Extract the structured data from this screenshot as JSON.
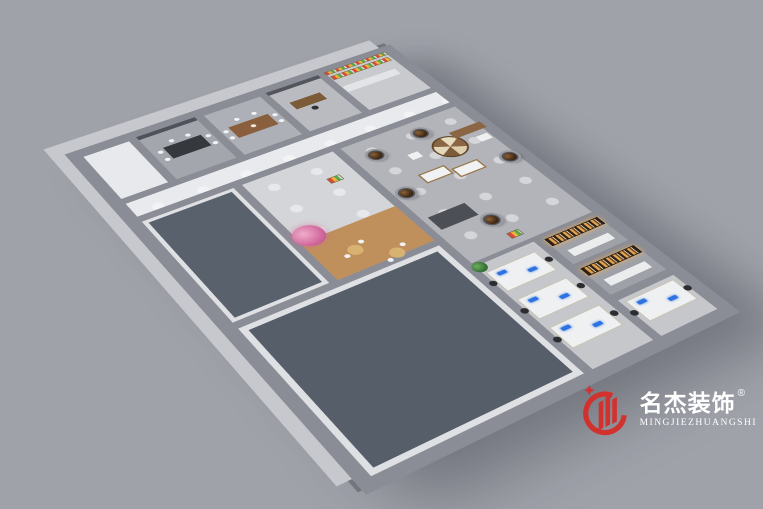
{
  "colors": {
    "background": "#a0a2aa",
    "wall": "#8b8d96",
    "wall_outer_light": "#c7c8ce",
    "accent_red": "#d2322e",
    "logo_text": "#ffffff"
  },
  "logo": {
    "name_cn": "名杰装饰",
    "registered_mark": "®",
    "name_en": "MINGJIEZHUANGSHI"
  },
  "floorplan": {
    "rooms": [
      {
        "name": "lobby-corner",
        "rect": [
          0,
          0,
          64,
          100
        ],
        "floor": "#e8e9ec"
      },
      {
        "name": "meeting-room-1",
        "rect": [
          64,
          0,
          82,
          100
        ],
        "floor": "#a3a6ad"
      },
      {
        "name": "meeting-room-2-tea",
        "rect": [
          146,
          0,
          82,
          100
        ],
        "floor": "#adb0b6"
      },
      {
        "name": "manager-office",
        "rect": [
          228,
          0,
          78,
          100
        ],
        "floor": "#babbc0"
      },
      {
        "name": "pantry-bar",
        "rect": [
          306,
          0,
          94,
          100
        ],
        "floor": "#c9cacd"
      },
      {
        "name": "corridor",
        "rect": [
          0,
          100,
          400,
          36
        ],
        "floor": "#e9eaed",
        "cls": "pools"
      },
      {
        "name": "training-room-west",
        "rect": [
          0,
          136,
          116,
          194
        ],
        "floor": "#dfe0e3"
      },
      {
        "name": "break-room",
        "rect": [
          116,
          136,
          122,
          194
        ],
        "floor": "#d4d5d8",
        "cls": "pools"
      },
      {
        "name": "showroom",
        "rect": [
          238,
          136,
          162,
          244
        ],
        "floor": "#b3b4b9",
        "cls": "pools"
      },
      {
        "name": "training-room-south",
        "rect": [
          0,
          330,
          238,
          230
        ],
        "floor": "#dfe0e3"
      },
      {
        "name": "open-office",
        "rect": [
          238,
          376,
          82,
          184
        ],
        "floor": "#c6c7cb"
      },
      {
        "name": "open-office-ext",
        "rect": [
          320,
          490,
          80,
          70
        ],
        "floor": "#c6c7cb"
      },
      {
        "name": "material-room-1",
        "rect": [
          320,
          380,
          80,
          55
        ],
        "floor": "#9fa1a8"
      },
      {
        "name": "material-room-2",
        "rect": [
          320,
          435,
          80,
          55
        ],
        "floor": "#9fa1a8"
      }
    ],
    "items": [
      {
        "name": "carpet-west",
        "rect": [
          10,
          146,
          96,
          174
        ],
        "color": "#59616d"
      },
      {
        "name": "carpet-south",
        "rect": [
          12,
          342,
          214,
          206
        ],
        "color": "#565e6a"
      },
      {
        "name": "accent-wall",
        "rect": [
          69,
          2,
          72,
          7
        ],
        "color": "#4f525a"
      },
      {
        "name": "conference-table",
        "rect": [
          84,
          36,
          46,
          24
        ],
        "color": "#35383d"
      },
      {
        "name": "chair",
        "shape": "circle",
        "c": [
          78,
          42
        ],
        "r": 3,
        "color": "#f2f3f5"
      },
      {
        "name": "chair",
        "shape": "circle",
        "c": [
          78,
          58
        ],
        "r": 3,
        "color": "#f2f3f5"
      },
      {
        "name": "chair",
        "shape": "circle",
        "c": [
          136,
          42
        ],
        "r": 3,
        "color": "#f2f3f5"
      },
      {
        "name": "chair",
        "shape": "circle",
        "c": [
          136,
          58
        ],
        "r": 3,
        "color": "#f2f3f5"
      },
      {
        "name": "chair",
        "shape": "circle",
        "c": [
          98,
          29
        ],
        "r": 3,
        "color": "#f2f3f5"
      },
      {
        "name": "chair",
        "shape": "circle",
        "c": [
          118,
          29
        ],
        "r": 3,
        "color": "#f2f3f5"
      },
      {
        "name": "tea-table",
        "rect": [
          162,
          40,
          50,
          24
        ],
        "color": "#8a5f3d"
      },
      {
        "name": "tea-set",
        "shape": "circle",
        "c": [
          187,
          52
        ],
        "r": 3,
        "color": "#f4e9d8"
      },
      {
        "name": "chair",
        "shape": "circle",
        "c": [
          156,
          46
        ],
        "r": 3,
        "color": "#f2f3f5"
      },
      {
        "name": "chair",
        "shape": "circle",
        "c": [
          156,
          60
        ],
        "r": 3,
        "color": "#f2f3f5"
      },
      {
        "name": "chair",
        "shape": "circle",
        "c": [
          218,
          46
        ],
        "r": 3,
        "color": "#f2f3f5"
      },
      {
        "name": "chair",
        "shape": "circle",
        "c": [
          218,
          60
        ],
        "r": 3,
        "color": "#f2f3f5"
      },
      {
        "name": "chair",
        "shape": "circle",
        "c": [
          178,
          31
        ],
        "r": 3,
        "color": "#f2f3f5"
      },
      {
        "name": "chair",
        "shape": "circle",
        "c": [
          200,
          31
        ],
        "r": 3,
        "color": "#f2f3f5"
      },
      {
        "name": "cabinet",
        "rect": [
          232,
          2,
          70,
          7
        ],
        "color": "#53565c"
      },
      {
        "name": "office-desk",
        "rect": [
          244,
          34,
          40,
          16
        ],
        "color": "#7c5b39"
      },
      {
        "name": "office-chair",
        "shape": "circle",
        "c": [
          263,
          58
        ],
        "r": 4,
        "color": "#2e3033"
      },
      {
        "name": "bar-counter",
        "rect": [
          312,
          38,
          72,
          13
        ],
        "color": "#e3e4e7"
      },
      {
        "name": "product-shelf",
        "rect": [
          312,
          12,
          80,
          9
        ],
        "cls": "produce"
      },
      {
        "name": "product-wall",
        "rect": [
          310,
          1,
          86,
          7
        ],
        "cls": "produce"
      },
      {
        "name": "wood-deck",
        "rect": [
          120,
          258,
          114,
          68
        ],
        "color": "#c0905c"
      },
      {
        "name": "blossom-tree",
        "shape": "circle",
        "c": [
          134,
          252
        ],
        "r": 17,
        "cls": "blossom"
      },
      {
        "name": "cafe-table",
        "shape": "circle",
        "c": [
          160,
          296
        ],
        "r": 8,
        "color": "#d8b271"
      },
      {
        "name": "cafe-table",
        "shape": "circle",
        "c": [
          192,
          322
        ],
        "r": 8,
        "color": "#d8b271"
      },
      {
        "name": "chair",
        "shape": "circle",
        "c": [
          148,
          300
        ],
        "r": 3,
        "color": "#f2f3f5"
      },
      {
        "name": "chair",
        "shape": "circle",
        "c": [
          172,
          288
        ],
        "r": 3,
        "color": "#f2f3f5"
      },
      {
        "name": "chair",
        "shape": "circle",
        "c": [
          180,
          328
        ],
        "r": 3,
        "color": "#f2f3f5"
      },
      {
        "name": "chair",
        "shape": "circle",
        "c": [
          204,
          314
        ],
        "r": 3,
        "color": "#f2f3f5"
      },
      {
        "name": "fruit-cart",
        "rect": [
          200,
          180,
          16,
          10
        ],
        "cls": "produce"
      },
      {
        "name": "vase-column",
        "shape": "circle",
        "c": [
          268,
          172
        ],
        "r": 9,
        "cls": "column"
      },
      {
        "name": "vase-column",
        "shape": "circle",
        "c": [
          332,
          164
        ],
        "r": 9,
        "cls": "column"
      },
      {
        "name": "vase-column",
        "shape": "circle",
        "c": [
          256,
          246
        ],
        "r": 9,
        "cls": "column"
      },
      {
        "name": "vase-column",
        "shape": "circle",
        "c": [
          386,
          252
        ],
        "r": 9,
        "cls": "column"
      },
      {
        "name": "vase-column",
        "shape": "circle",
        "c": [
          302,
          330
        ],
        "r": 9,
        "cls": "column"
      },
      {
        "name": "display-table-round",
        "shape": "circle",
        "c": [
          344,
          202
        ],
        "r": 20,
        "cls": "display-round"
      },
      {
        "name": "display-counter",
        "rect": [
          284,
          226,
          34,
          18
        ],
        "color": "#f1f2f4",
        "cls": "wood-edge"
      },
      {
        "name": "display-counter",
        "rect": [
          320,
          236,
          34,
          18
        ],
        "color": "#f1f2f4",
        "cls": "wood-edge"
      },
      {
        "name": "display-shelf",
        "rect": [
          358,
          180,
          42,
          13
        ],
        "color": "#8a6645"
      },
      {
        "name": "sofa",
        "rect": [
          250,
          292,
          46,
          24
        ],
        "color": "#4c4f55"
      },
      {
        "name": "display-cube",
        "rect": [
          296,
          190,
          13,
          11
        ],
        "color": "#eef0f2"
      },
      {
        "name": "display-cube",
        "rect": [
          378,
          202,
          15,
          11
        ],
        "color": "#eef0f2"
      },
      {
        "name": "veg-cart",
        "rect": [
          300,
          356,
          15,
          10
        ],
        "cls": "produce"
      },
      {
        "name": "sample-shelves",
        "rect": [
          326,
          384,
          68,
          13
        ],
        "cls": "shelves"
      },
      {
        "name": "sample-table",
        "rect": [
          334,
          410,
          52,
          11
        ],
        "color": "#ebecee"
      },
      {
        "name": "sample-shelves",
        "rect": [
          326,
          439,
          68,
          13
        ],
        "cls": "shelves"
      },
      {
        "name": "sample-table",
        "rect": [
          334,
          464,
          52,
          11
        ],
        "color": "#ebecee"
      },
      {
        "name": "office-plant",
        "shape": "circle",
        "c": [
          246,
          384
        ],
        "r": 8,
        "cls": "plant"
      },
      {
        "name": "workstation",
        "rect": [
          246,
          394,
          60,
          34
        ],
        "color": "#eef0f2",
        "cls": "desk"
      },
      {
        "name": "workstation",
        "rect": [
          246,
          442,
          60,
          34
        ],
        "color": "#eef0f2",
        "cls": "desk"
      },
      {
        "name": "workstation",
        "rect": [
          246,
          490,
          60,
          34
        ],
        "color": "#eef0f2",
        "cls": "desk"
      },
      {
        "name": "workstation",
        "rect": [
          330,
          500,
          60,
          34
        ],
        "color": "#eef0f2",
        "cls": "desk"
      },
      {
        "name": "monitor",
        "rect": [
          254,
          400,
          10,
          5
        ],
        "color": "#2e72e0",
        "cls": "screen"
      },
      {
        "name": "monitor",
        "rect": [
          282,
          412,
          10,
          5
        ],
        "color": "#2e72e0",
        "cls": "screen"
      },
      {
        "name": "monitor",
        "rect": [
          254,
          448,
          10,
          5
        ],
        "color": "#2e72e0",
        "cls": "screen"
      },
      {
        "name": "monitor",
        "rect": [
          282,
          460,
          10,
          5
        ],
        "color": "#2e72e0",
        "cls": "screen"
      },
      {
        "name": "monitor",
        "rect": [
          254,
          496,
          10,
          5
        ],
        "color": "#2e72e0",
        "cls": "screen"
      },
      {
        "name": "monitor",
        "rect": [
          282,
          508,
          10,
          5
        ],
        "color": "#2e72e0",
        "cls": "screen"
      },
      {
        "name": "monitor",
        "rect": [
          338,
          506,
          10,
          5
        ],
        "color": "#2e72e0",
        "cls": "screen"
      },
      {
        "name": "monitor",
        "rect": [
          366,
          518,
          10,
          5
        ],
        "color": "#2e72e0",
        "cls": "screen"
      },
      {
        "name": "office-chair",
        "shape": "circle",
        "c": [
          242,
          411
        ],
        "r": 4,
        "color": "#2b2d31"
      },
      {
        "name": "office-chair",
        "shape": "circle",
        "c": [
          310,
          411
        ],
        "r": 4,
        "color": "#2b2d31"
      },
      {
        "name": "office-chair",
        "shape": "circle",
        "c": [
          242,
          459
        ],
        "r": 4,
        "color": "#2b2d31"
      },
      {
        "name": "office-chair",
        "shape": "circle",
        "c": [
          310,
          459
        ],
        "r": 4,
        "color": "#2b2d31"
      },
      {
        "name": "office-chair",
        "shape": "circle",
        "c": [
          242,
          507
        ],
        "r": 4,
        "color": "#2b2d31"
      },
      {
        "name": "office-chair",
        "shape": "circle",
        "c": [
          310,
          507
        ],
        "r": 4,
        "color": "#2b2d31"
      },
      {
        "name": "office-chair",
        "shape": "circle",
        "c": [
          326,
          517
        ],
        "r": 4,
        "color": "#2b2d31"
      },
      {
        "name": "office-chair",
        "shape": "circle",
        "c": [
          393,
          517
        ],
        "r": 4,
        "color": "#2b2d31"
      }
    ]
  }
}
